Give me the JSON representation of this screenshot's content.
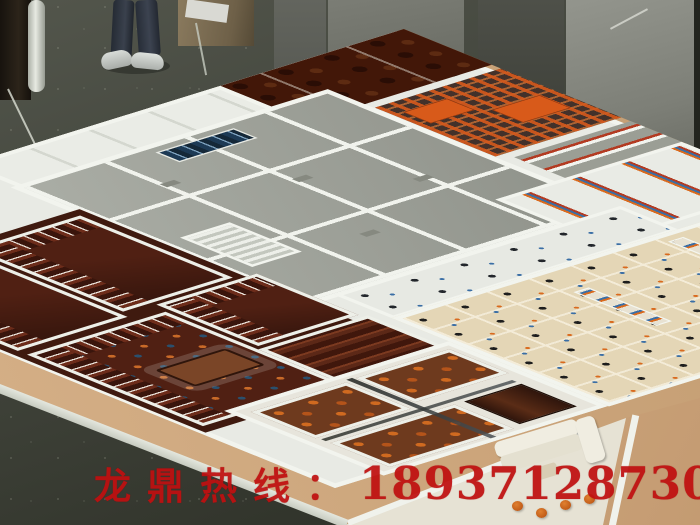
{
  "watermark": {
    "label": "龙鼎热线：",
    "phone": "18937128730",
    "color": "#c01010"
  },
  "palette": {
    "workshop_floor": "#3c3f36",
    "backdrop_panel_gray": "#858780",
    "model_wall_white": "#f2f4ee",
    "roof_gray": "#a3a69e",
    "library_wood_dark": "#4a1d12",
    "furniture_wood": "#7a3a22",
    "office_beige": "#e4d6b6",
    "base_board_tan": "#cfa87e",
    "rack_orange": "#d85a1a",
    "chair_black": "#1d1d1d",
    "book_blue": "#3a6ea5",
    "book_orange": "#d96a1e",
    "seat_red": "#b33b22",
    "jeans_blue": "#2c323c"
  }
}
